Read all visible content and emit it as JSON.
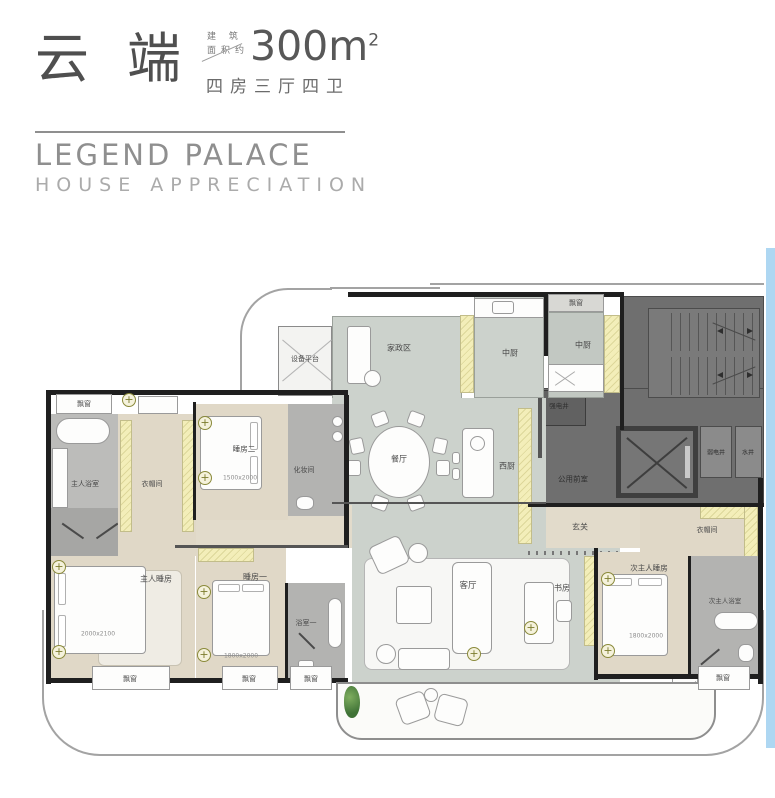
{
  "header": {
    "title": "云端",
    "area_label_line1": "建 筑",
    "area_label_line2": "面积约",
    "area_value": "300m",
    "area_superscript": "2",
    "layout_text": "四房三厅四卫",
    "brand_title": "LEGEND PALACE",
    "brand_subtitle": "HOUSE APPRECIATION"
  },
  "plan": {
    "labels": {
      "equipment_platform": "设备平台",
      "housekeeping_area": "家政区",
      "chinese_kitchen": "中厨",
      "bay_window": "飘窗",
      "dining_room": "餐厅",
      "west_kitchen": "西厨",
      "strong_electric_shaft": "强电井",
      "weak_electric_shaft": "弱电井",
      "water_shaft": "水井",
      "shared_front_room": "公用前室",
      "foyer": "玄关",
      "master_bathroom": "主人浴室",
      "cloakroom": "衣帽间",
      "bedroom_two": "睡房二",
      "makeup_room": "化妆间",
      "master_bedroom": "主人睡房",
      "bedroom_one": "睡房一",
      "bathroom_one": "浴室一",
      "living_room": "客厅",
      "study": "书房",
      "second_master_bedroom": "次主人睡房",
      "second_master_bathroom": "次主人浴室"
    },
    "bed_dimensions": {
      "bedroom_two": "1500x2000",
      "master_bedroom": "2000x2100",
      "bedroom_one": "1800x2000",
      "second_master_bedroom": "1800x2000"
    },
    "colors": {
      "bedroom_floor": "#e0d8c7",
      "living_floor": "#ccd2cc",
      "bathroom_floor": "#b3b3b1",
      "core_gray": "#6f6f6f",
      "closet_highlight": "#f3eeb9",
      "edge_blue": "#aed7f2"
    }
  }
}
